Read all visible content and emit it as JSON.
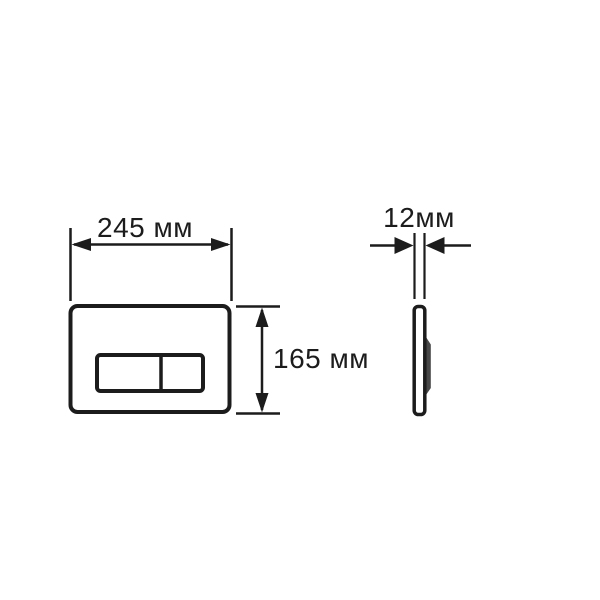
{
  "page": {
    "background": "#ffffff"
  },
  "diagram": {
    "type": "technical-drawing",
    "subject": "flush-plate-dimensions",
    "line_color": "#1c1c1c",
    "front_view": {
      "width_label": "245 мм",
      "height_label": "165 мм"
    },
    "side_view": {
      "thickness_label": "12мм",
      "profile_bump_color": "#474747"
    }
  }
}
